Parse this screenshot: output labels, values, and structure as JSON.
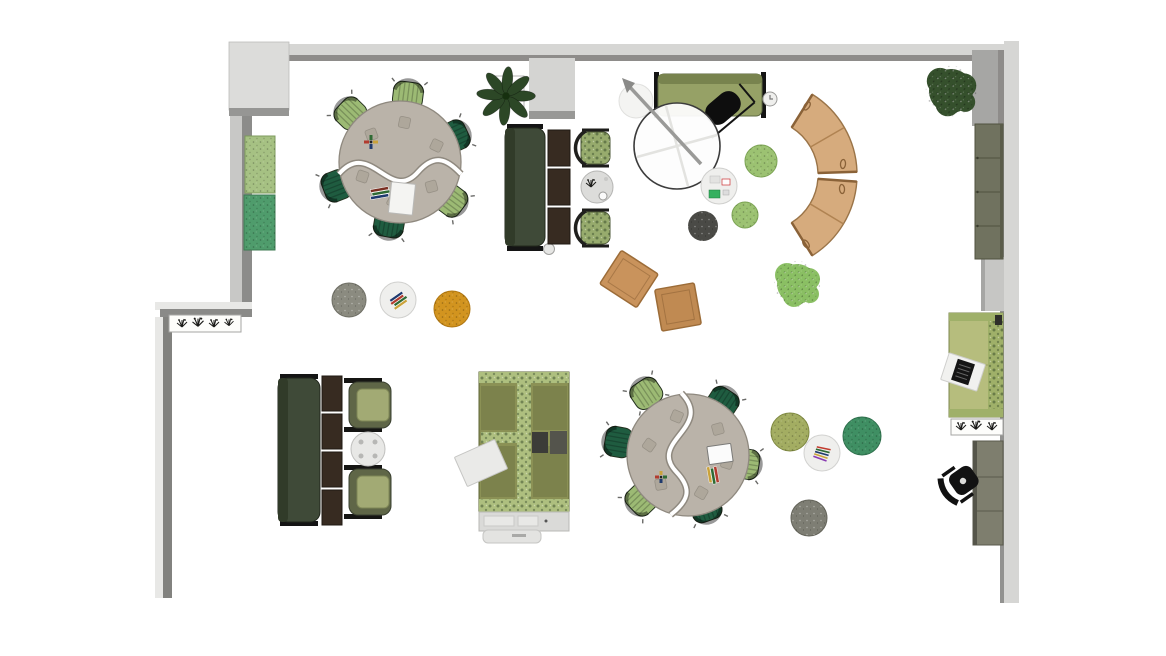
{
  "title": "Office floor plan, top-down furniture layout",
  "palette": {
    "floor": "#ffffff",
    "wall_light": "#d6d6d4",
    "wall_pale": "#e8e8e6",
    "wall_mid": "#b2b2b0",
    "wall_dark": "#8c8c8a",
    "table_top": "#bab3a9",
    "table_edge": "#8f897f",
    "chair_light": "#9cba74",
    "chair_dark": "#1f5c40",
    "wicker": "#97ab6d",
    "armchair": "#a2aa74",
    "sofa_dark": "#3f4a38",
    "sofa_olive": "#96a166",
    "side_table": "#372b21",
    "pouf_green": "#9cc272",
    "pouf_dark": "#4a4a46",
    "pouf_gray": "#8b8b80",
    "pouf_orange": "#d2941f",
    "pouf_olive": "#a3ad62",
    "pouf_teal": "#3f8f63",
    "pouf_gray2": "#7e7e74",
    "coffee_white": "#efefed",
    "bench_wood": "#d6ab7d",
    "bench_dark": "#a87848",
    "cushion_tan": "#c9935c",
    "booth": "#8b9155",
    "booth_strip": "#aebf7f",
    "console": "#dadad8",
    "cabinet": "#70725f",
    "desk": "#7e7e6e",
    "sofa_right": "#b6bd7d",
    "panel_green": "#a6c183",
    "panel_teal": "#4f9c6c",
    "plant_dark": "#2c4726",
    "plant_light": "#8abf63",
    "tree": "#35502c",
    "black": "#121212"
  },
  "inventory": [
    {
      "id": "serpentine-table-northwest",
      "label": "two-part serpentine meeting table",
      "chairs": 6
    },
    {
      "id": "serpentine-table-southeast",
      "label": "two-part serpentine meeting table",
      "chairs": 6
    },
    {
      "id": "lounge-north",
      "label": "dark green sofa, three side tables, two wicker chairs, round side table"
    },
    {
      "id": "lounge-southwest",
      "label": "dark green sofa, four side tables, two olive armchairs, round table"
    },
    {
      "id": "media-lounge-center",
      "label": "olive sofa, black lounge chair, flip-chart easel, coffee table, three poufs, two floor cushions"
    },
    {
      "id": "curved-bench-east",
      "label": "curved wooden bench in two segments"
    },
    {
      "id": "booth-south",
      "label": "high-back booth settee with centre divider and storage console"
    },
    {
      "id": "east-wall-run",
      "label": "storage cabinet, green daybed with laptop tray, planter box, desk with task chair"
    },
    {
      "id": "pouf-cluster-west",
      "label": "gray pouf, white coffee table, orange pouf"
    },
    {
      "id": "pouf-cluster-east",
      "label": "olive pouf, white coffee table, teal pouf, gray pouf"
    },
    {
      "id": "wall-panels-west",
      "label": "green and teal acoustic wall panels"
    },
    {
      "id": "plants",
      "label": "two dark leaf plants, one light fluffy plant, two planter boxes"
    }
  ]
}
